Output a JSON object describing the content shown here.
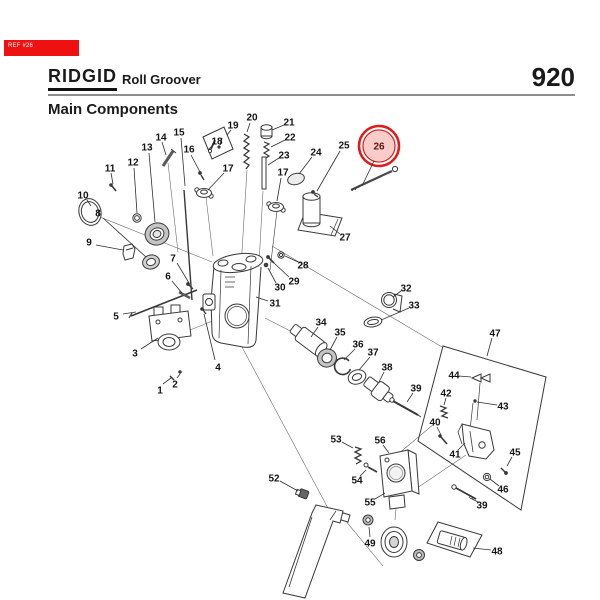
{
  "badge": {
    "label": "REF #26",
    "bg": "#ee1111",
    "text_color": "#ffffff"
  },
  "header": {
    "brand": "RIDGID",
    "product": "Roll Groover",
    "model": "920",
    "section": "Main Components"
  },
  "diagram": {
    "number_color": "#141414",
    "line_color": "#2e2e2e",
    "highlight": {
      "callout": "26",
      "cx": 379,
      "cy": 146,
      "r_outer": 20,
      "r_mid": 16,
      "r_fill": 15,
      "ring_color": "#e01b1b",
      "fill_color": "#f2a49c",
      "fill_opacity": 0.55
    },
    "callouts": [
      {
        "n": "1",
        "x": 160,
        "y": 390,
        "l": [
          163,
          384,
          171,
          378
        ]
      },
      {
        "n": "2",
        "x": 175,
        "y": 384,
        "l": [
          177,
          378,
          180,
          374
        ]
      },
      {
        "n": "3",
        "x": 135,
        "y": 353,
        "l": [
          141,
          349,
          158,
          338
        ]
      },
      {
        "n": "4",
        "x": 218,
        "y": 367,
        "l": [
          215,
          360,
          204,
          314
        ]
      },
      {
        "n": "5",
        "x": 116,
        "y": 316,
        "l": [
          123,
          314,
          136,
          312
        ]
      },
      {
        "n": "6",
        "x": 168,
        "y": 276,
        "l": [
          172,
          281,
          182,
          293
        ]
      },
      {
        "n": "7",
        "x": 173,
        "y": 258,
        "l": [
          177,
          263,
          189,
          283
        ]
      },
      {
        "n": "8",
        "x": 98,
        "y": 213,
        "l": [
          103,
          218,
          146,
          257
        ]
      },
      {
        "n": "9",
        "x": 89,
        "y": 242,
        "l": [
          96,
          245,
          123,
          250
        ]
      },
      {
        "n": "10",
        "x": 83,
        "y": 195,
        "l": [
          87,
          200,
          91,
          206
        ]
      },
      {
        "n": "11",
        "x": 110,
        "y": 168,
        "l": [
          111,
          173,
          113,
          184
        ]
      },
      {
        "n": "12",
        "x": 133,
        "y": 162,
        "l": [
          134,
          168,
          137,
          213
        ]
      },
      {
        "n": "13",
        "x": 147,
        "y": 147,
        "l": [
          149,
          153,
          155,
          222
        ]
      },
      {
        "n": "14",
        "x": 161,
        "y": 137,
        "l": [
          162,
          142,
          166,
          155
        ]
      },
      {
        "n": "15",
        "x": 179,
        "y": 132,
        "l": [
          181,
          138,
          185,
          186
        ]
      },
      {
        "n": "16",
        "x": 189,
        "y": 149,
        "l": [
          191,
          155,
          200,
          172
        ]
      },
      {
        "n": "17",
        "x": 228,
        "y": 168,
        "l": [
          224,
          173,
          208,
          190
        ]
      },
      {
        "n": "17",
        "x": 283,
        "y": 172,
        "l": [
          281,
          178,
          277,
          201
        ]
      },
      {
        "n": "18",
        "x": 217,
        "y": 141,
        "l": [
          213,
          145,
          208,
          150
        ]
      },
      {
        "n": "19",
        "x": 233,
        "y": 125,
        "l": [
          231,
          130,
          227,
          135
        ]
      },
      {
        "n": "20",
        "x": 252,
        "y": 117,
        "l": [
          250,
          123,
          247,
          132
        ]
      },
      {
        "n": "21",
        "x": 289,
        "y": 122,
        "l": [
          284,
          125,
          272,
          130
        ]
      },
      {
        "n": "22",
        "x": 290,
        "y": 137,
        "l": [
          285,
          140,
          271,
          147
        ]
      },
      {
        "n": "23",
        "x": 284,
        "y": 155,
        "l": [
          279,
          158,
          268,
          165
        ]
      },
      {
        "n": "24",
        "x": 316,
        "y": 152,
        "l": [
          312,
          157,
          299,
          174
        ]
      },
      {
        "n": "25",
        "x": 344,
        "y": 145,
        "l": [
          340,
          151,
          317,
          191
        ]
      },
      {
        "n": "26",
        "x": 379,
        "y": 146,
        "l": [
          374,
          161,
          362,
          186
        ],
        "c": "#5d1412"
      },
      {
        "n": "27",
        "x": 345,
        "y": 237,
        "l": [
          340,
          234,
          330,
          226
        ]
      },
      {
        "n": "28",
        "x": 303,
        "y": 265,
        "l": [
          298,
          262,
          285,
          256
        ]
      },
      {
        "n": "29",
        "x": 294,
        "y": 281,
        "l": [
          289,
          277,
          274,
          263
        ]
      },
      {
        "n": "30",
        "x": 280,
        "y": 287,
        "l": [
          276,
          283,
          268,
          268
        ]
      },
      {
        "n": "31",
        "x": 275,
        "y": 303,
        "l": [
          268,
          301,
          256,
          297
        ]
      },
      {
        "n": "32",
        "x": 406,
        "y": 288,
        "l": [
          401,
          291,
          393,
          297
        ]
      },
      {
        "n": "33",
        "x": 414,
        "y": 305,
        "l": [
          409,
          308,
          381,
          320
        ]
      },
      {
        "n": "34",
        "x": 321,
        "y": 322,
        "l": [
          318,
          327,
          311,
          337
        ]
      },
      {
        "n": "35",
        "x": 340,
        "y": 332,
        "l": [
          337,
          337,
          330,
          350
        ]
      },
      {
        "n": "36",
        "x": 358,
        "y": 344,
        "l": [
          355,
          349,
          344,
          360
        ]
      },
      {
        "n": "37",
        "x": 373,
        "y": 352,
        "l": [
          370,
          357,
          359,
          370
        ]
      },
      {
        "n": "38",
        "x": 387,
        "y": 367,
        "l": [
          384,
          372,
          379,
          382
        ]
      },
      {
        "n": "39",
        "x": 416,
        "y": 388,
        "l": [
          413,
          393,
          407,
          402
        ]
      },
      {
        "n": "40",
        "x": 435,
        "y": 422,
        "l": [
          437,
          427,
          441,
          435
        ]
      },
      {
        "n": "41",
        "x": 455,
        "y": 454,
        "l": [
          458,
          450,
          465,
          443
        ]
      },
      {
        "n": "42",
        "x": 446,
        "y": 393,
        "l": [
          446,
          398,
          444,
          405
        ]
      },
      {
        "n": "43",
        "x": 503,
        "y": 406,
        "l": [
          497,
          405,
          477,
          402
        ]
      },
      {
        "n": "44",
        "x": 454,
        "y": 375,
        "l": [
          459,
          376,
          471,
          377
        ]
      },
      {
        "n": "45",
        "x": 515,
        "y": 452,
        "l": [
          512,
          457,
          507,
          466
        ]
      },
      {
        "n": "46",
        "x": 503,
        "y": 489,
        "l": [
          499,
          486,
          490,
          479
        ]
      },
      {
        "n": "39",
        "x": 482,
        "y": 505,
        "l": [
          478,
          502,
          470,
          498
        ]
      },
      {
        "n": "47",
        "x": 495,
        "y": 333,
        "l": [
          492,
          338,
          487,
          356
        ]
      },
      {
        "n": "48",
        "x": 497,
        "y": 551,
        "l": [
          491,
          550,
          473,
          548
        ]
      },
      {
        "n": "49",
        "x": 370,
        "y": 543,
        "l": [
          370,
          537,
          369,
          527
        ]
      },
      {
        "n": "52",
        "x": 274,
        "y": 478,
        "l": [
          280,
          481,
          298,
          491
        ]
      },
      {
        "n": "53",
        "x": 336,
        "y": 439,
        "l": [
          342,
          442,
          353,
          448
        ]
      },
      {
        "n": "54",
        "x": 357,
        "y": 480,
        "l": [
          360,
          476,
          366,
          470
        ]
      },
      {
        "n": "55",
        "x": 370,
        "y": 502,
        "l": [
          375,
          499,
          385,
          493
        ]
      },
      {
        "n": "56",
        "x": 380,
        "y": 440,
        "l": [
          383,
          445,
          389,
          453
        ]
      }
    ]
  }
}
